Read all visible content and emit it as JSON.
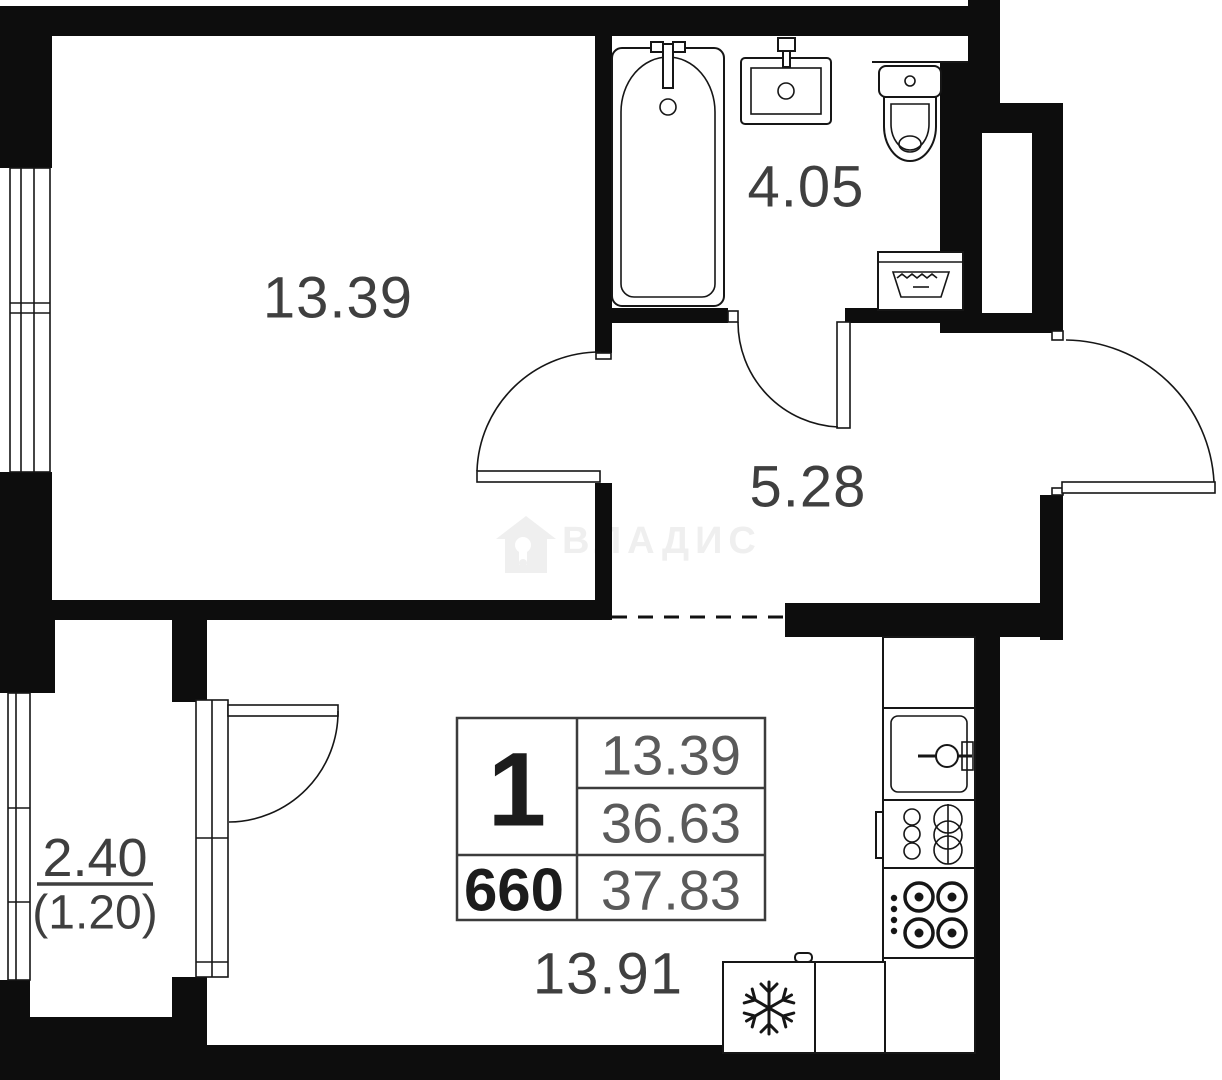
{
  "plan": {
    "watermark": {
      "text": "ВЛАДИС"
    },
    "room_labels": {
      "living": "13.39",
      "bathroom": "4.05",
      "hallway": "5.28",
      "kitchen_living": "13.91",
      "balcony_primary": "2.40",
      "balcony_secondary": "(1.20)"
    },
    "info_table": {
      "top_left": "1",
      "bottom_left": "660",
      "right_column": [
        "13.39",
        "36.63",
        "37.83"
      ]
    },
    "colors": {
      "wall": "#0d0d0d",
      "label": "#3f3f3f",
      "light_value": "#5a5a5a",
      "watermark": "#efefef",
      "background": "#ffffff"
    },
    "icons": [
      "bathtub-icon",
      "bath-sink-icon",
      "toilet-icon",
      "washing-machine-icon",
      "kitchen-sink-icon",
      "oven-icon",
      "cooktop-icon",
      "fridge-icon",
      "snowflake-icon",
      "house-watermark-icon",
      "door-arc",
      "window",
      "dashed-opening"
    ]
  }
}
